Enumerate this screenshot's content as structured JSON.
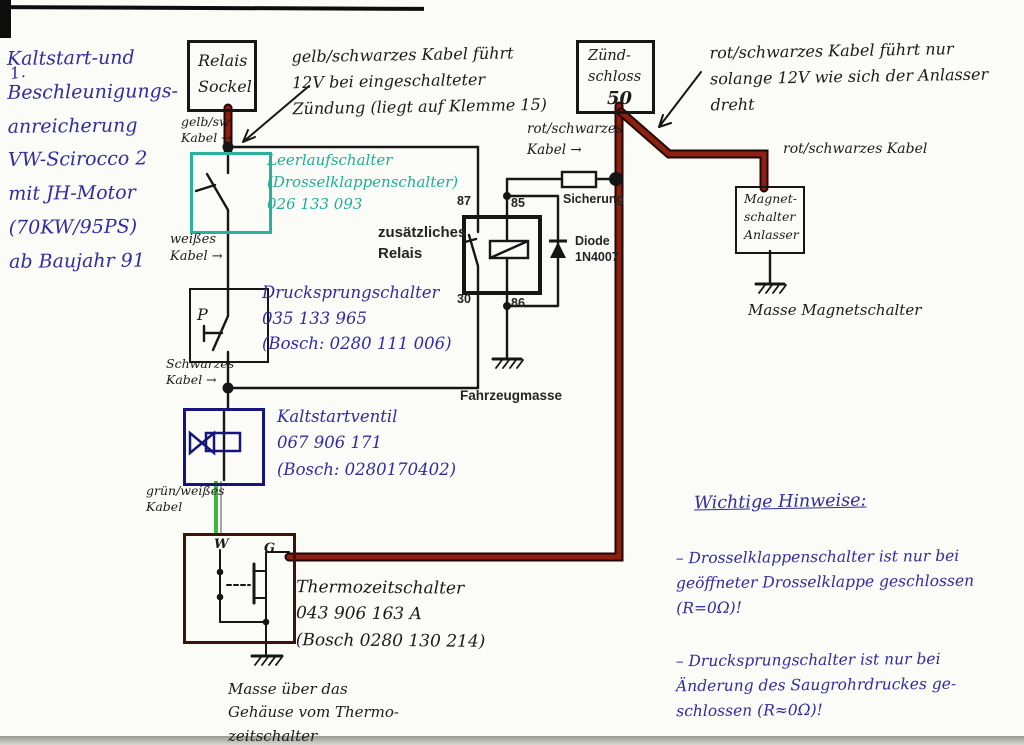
{
  "artifacts": {
    "corner_mark": "1."
  },
  "side_note": {
    "text": "Kaltstart-und\nBeschleunigungs-\nanreicherung\nVW-Scirocco 2\nmit JH-Motor\n(70KW/95PS)\nab Baujahr 91"
  },
  "annotations": {
    "gelb_kabel_note": "gelb/schwarzes Kabel führt\n12V bei eingeschalteter\nZündung (liegt auf Klemme 15)",
    "rot_kabel_note": "rot/schwarzes Kabel führt nur\nsolange 12V wie sich der Anlasser\ndreht",
    "masse_magnetschalter": "Masse Magnetschalter",
    "masse_thermo": "Masse über das\nGehäuse vom Thermo-\nzeitschalter"
  },
  "wire_labels": {
    "gelb_sw": "gelb/sw\nKabel →",
    "weisses": "weißes\nKabel →",
    "schwarzes": "Schwarzes\nKabel →",
    "gruen_weisses": "grün/weißes\nKabel",
    "rot_schwarzes_fuse": "rot/schwarzes\nKabel    →",
    "rot_schwarzes_right": "rot/schwarzes Kabel"
  },
  "components": {
    "relais_sockel": {
      "label": "Relais\nSockel"
    },
    "zuendschloss": {
      "label": "Zünd-\nschloss",
      "terminal": "50"
    },
    "magnetschalter": {
      "label": "Magnet-\nschalter\nAnlasser"
    },
    "leerlaufschalter": {
      "note": "Leerlaufschalter\n(Drosselklappenschalter)\n026 133 093"
    },
    "drucksprungschalter": {
      "symbol": "P",
      "note": "Drucksprungschalter\n035 133 965\n(Bosch: 0280 111 006)"
    },
    "kaltstartventil": {
      "note": "Kaltstartventil\n067 906 171\n(Bosch: 0280170402)"
    },
    "thermozeitschalter": {
      "terminal_w": "W",
      "terminal_g": "G",
      "note": "Thermozeitschalter\n043 906 163 A\n(Bosch 0280 130 214)"
    },
    "relay": {
      "label": "zusätzliches\nRelais",
      "t87": "87",
      "t85": "85",
      "t30": "30",
      "t86": "86"
    },
    "fuse": {
      "label": "Sicherung"
    },
    "diode": {
      "label": "Diode\n1N4007"
    },
    "fahrzeugmasse": "Fahrzeugmasse"
  },
  "hints": {
    "heading": "Wichtige Hinweise:",
    "items": [
      "– Drosselklappenschalter ist nur bei\ngeöffneter Drosselklappe geschlossen\n(R=0Ω)!",
      "– Drucksprungschalter ist nur bei\nÄnderung des Saugrohrdruckes ge-\nschlossen (R≈0Ω)!"
    ]
  },
  "colors": {
    "red_wire": "#8d2011",
    "teal_box": "#27b39b",
    "blue_ink": "#322c9e",
    "dark_blue_box": "#15157d",
    "maroon_box": "#40100a",
    "green_wire": "#3cb83c",
    "black_ink": "#161616"
  }
}
